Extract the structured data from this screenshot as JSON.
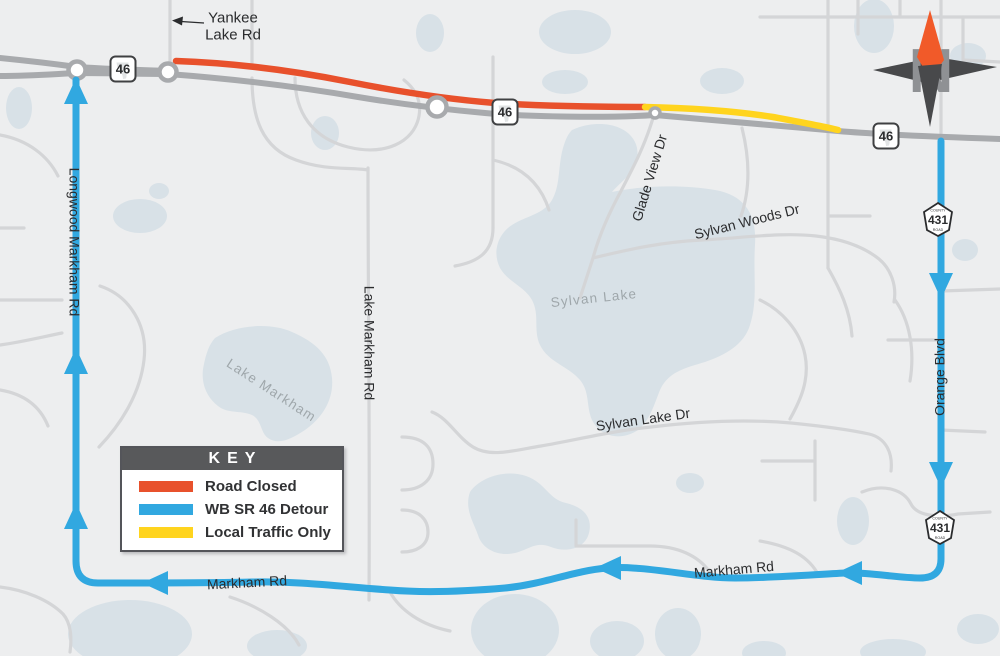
{
  "legend": {
    "title": "KEY",
    "items": [
      {
        "label": "Road Closed",
        "color": "#E8512C"
      },
      {
        "label": "WB SR 46 Detour",
        "color": "#31A8E0"
      },
      {
        "label": "Local Traffic Only",
        "color": "#FFD41E"
      }
    ]
  },
  "compass": {
    "north_label": "N"
  },
  "callout": {
    "line1": "Yankee",
    "line2": "Lake Rd"
  },
  "road_labels": {
    "glade_view_dr": "Glade View Dr",
    "sylvan_woods_dr": "Sylvan Woods Dr",
    "sylvan_lake_dr": "Sylvan Lake Dr",
    "lake_markham_rd": "Lake Markham Rd",
    "longwood_markham_rd": "Longwood Markham Rd",
    "orange_blvd": "Orange Blvd",
    "markham_rd": "Markham Rd"
  },
  "lake_labels": {
    "sylvan_lake": "Sylvan Lake",
    "lake_markham": "Lake Markham"
  },
  "shields": {
    "sr46": {
      "number": "46"
    },
    "cr431": {
      "number": "431",
      "top": "COUNTY",
      "bottom": "ROAD"
    }
  },
  "colors": {
    "background": "#EDEEEF",
    "water": "#D8E1E7",
    "minor_road": "#D4D5D7",
    "highway_gray": "#A8AAAD",
    "road_closed": "#E8512C",
    "detour": "#31A8E0",
    "local_traffic": "#FFD41E",
    "compass_orange": "#F15A29",
    "compass_dark": "#48494B"
  }
}
